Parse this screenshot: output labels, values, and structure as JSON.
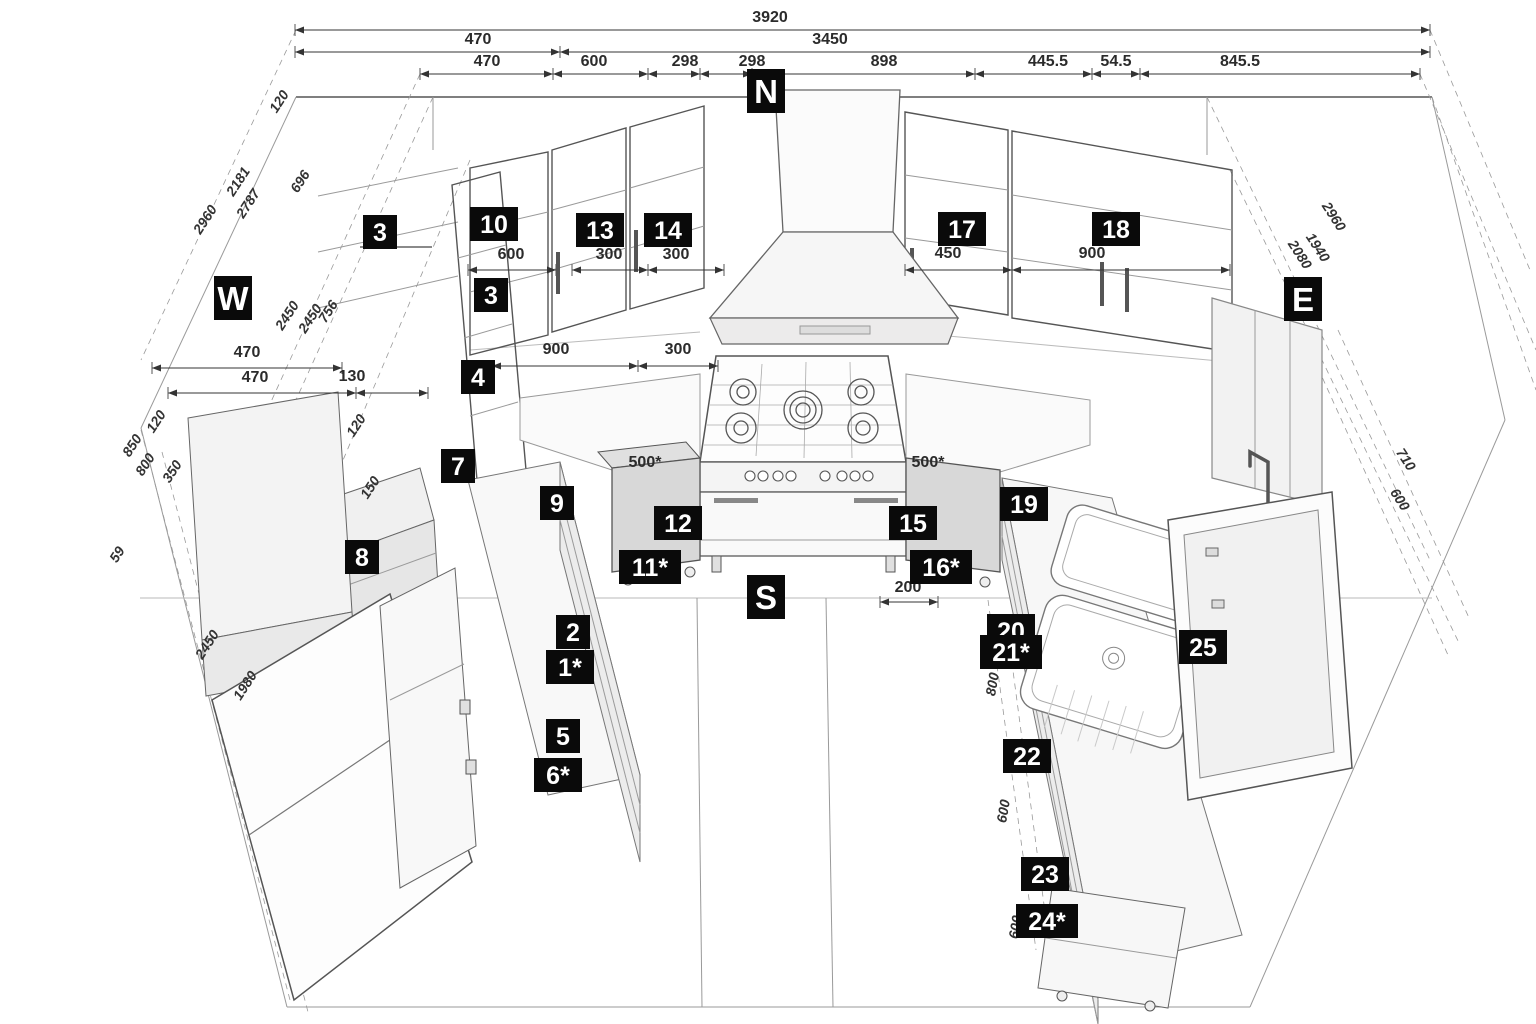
{
  "drawing": {
    "type": "kitchen-3d-dimension-plan",
    "colors": {
      "tag_bg": "#0a0a0a",
      "tag_fg": "#ffffff",
      "dim_line": "#333333",
      "cabinet_fill": "#ebebeb"
    }
  },
  "compass": [
    {
      "label": "N",
      "x": 766,
      "y": 91
    },
    {
      "label": "W",
      "x": 233,
      "y": 298
    },
    {
      "label": "E",
      "x": 1303,
      "y": 299
    },
    {
      "label": "S",
      "x": 766,
      "y": 597
    }
  ],
  "dim_rows": [
    {
      "y": 30,
      "segments": [
        {
          "x1": 295,
          "x2": 1430,
          "label": "3920",
          "tx": 770
        }
      ]
    },
    {
      "y": 52,
      "segments": [
        {
          "x1": 295,
          "x2": 560,
          "label": "470",
          "tx": 478
        },
        {
          "x1": 560,
          "x2": 1430,
          "label": "3450",
          "tx": 830
        }
      ]
    },
    {
      "y": 74,
      "segments": [
        {
          "x1": 420,
          "x2": 553,
          "label": "470",
          "tx": 487
        },
        {
          "x1": 553,
          "x2": 648,
          "label": "600",
          "tx": 594
        },
        {
          "x1": 648,
          "x2": 700,
          "label": "298",
          "tx": 685
        },
        {
          "x1": 700,
          "x2": 752,
          "label": "298",
          "tx": 752
        },
        {
          "x1": 752,
          "x2": 975,
          "label": "898",
          "tx": 884
        },
        {
          "x1": 975,
          "x2": 1092,
          "label": "445.5",
          "tx": 1048
        },
        {
          "x1": 1092,
          "x2": 1140,
          "label": "54.5",
          "tx": 1116
        },
        {
          "x1": 1140,
          "x2": 1420,
          "label": "845.5",
          "tx": 1240
        }
      ]
    }
  ],
  "dims_h": [
    {
      "label": "600",
      "x1": 468,
      "x2": 556,
      "y": 270,
      "tx": 511,
      "ty": 259
    },
    {
      "label": "300",
      "x1": 572,
      "x2": 648,
      "y": 270,
      "tx": 609,
      "ty": 259
    },
    {
      "label": "300",
      "x1": 648,
      "x2": 724,
      "y": 270,
      "tx": 676,
      "ty": 259
    },
    {
      "label": "450",
      "x1": 905,
      "x2": 1012,
      "y": 270,
      "tx": 948,
      "ty": 258
    },
    {
      "label": "900",
      "x1": 1012,
      "x2": 1230,
      "y": 270,
      "tx": 1092,
      "ty": 258
    },
    {
      "label": "900",
      "x1": 492,
      "x2": 638,
      "y": 366,
      "tx": 556,
      "ty": 354
    },
    {
      "label": "300",
      "x1": 638,
      "x2": 718,
      "y": 366,
      "tx": 678,
      "ty": 354
    },
    {
      "label": "200",
      "x1": 880,
      "x2": 938,
      "y": 602,
      "tx": 908,
      "ty": 592
    },
    {
      "label": "470",
      "x1": 152,
      "x2": 342,
      "y": 368,
      "tx": 247,
      "ty": 357
    },
    {
      "label": "470",
      "x1": 168,
      "x2": 356,
      "y": 393,
      "tx": 255,
      "ty": 382
    },
    {
      "label": "130",
      "x1": 356,
      "x2": 428,
      "y": 393,
      "tx": 352,
      "ty": 381
    }
  ],
  "dims_free": [
    {
      "label": "500*",
      "tx": 645,
      "ty": 467
    },
    {
      "label": "500*",
      "tx": 928,
      "ty": 467
    }
  ],
  "dims_rot": [
    {
      "label": "120",
      "x": 283,
      "y": 104,
      "rot": -57
    },
    {
      "label": "2960",
      "x": 209,
      "y": 222,
      "rot": -57
    },
    {
      "label": "2181",
      "x": 242,
      "y": 184,
      "rot": -57
    },
    {
      "label": "2787",
      "x": 252,
      "y": 206,
      "rot": -57
    },
    {
      "label": "696",
      "x": 304,
      "y": 184,
      "rot": -57
    },
    {
      "label": "2450",
      "x": 291,
      "y": 318,
      "rot": -57
    },
    {
      "label": "2450",
      "x": 314,
      "y": 321,
      "rot": -57
    },
    {
      "label": "756",
      "x": 332,
      "y": 314,
      "rot": -57
    },
    {
      "label": "120",
      "x": 360,
      "y": 428,
      "rot": -57
    },
    {
      "label": "120",
      "x": 160,
      "y": 424,
      "rot": -57
    },
    {
      "label": "850",
      "x": 136,
      "y": 448,
      "rot": -57
    },
    {
      "label": "800",
      "x": 149,
      "y": 467,
      "rot": -57
    },
    {
      "label": "350",
      "x": 176,
      "y": 474,
      "rot": -57
    },
    {
      "label": "59",
      "x": 121,
      "y": 557,
      "rot": -57
    },
    {
      "label": "2450",
      "x": 211,
      "y": 647,
      "rot": -57
    },
    {
      "label": "1980",
      "x": 249,
      "y": 688,
      "rot": -57
    },
    {
      "label": "150",
      "x": 374,
      "y": 490,
      "rot": -57
    },
    {
      "label": "2960",
      "x": 1330,
      "y": 219,
      "rot": 57
    },
    {
      "label": "1940",
      "x": 1314,
      "y": 250,
      "rot": 57
    },
    {
      "label": "2080",
      "x": 1296,
      "y": 257,
      "rot": 57
    },
    {
      "label": "710",
      "x": 1402,
      "y": 462,
      "rot": 57
    },
    {
      "label": "600",
      "x": 1396,
      "y": 502,
      "rot": 57
    },
    {
      "label": "800",
      "x": 997,
      "y": 685,
      "rot": -80
    },
    {
      "label": "600",
      "x": 1008,
      "y": 812,
      "rot": -80
    },
    {
      "label": "600",
      "x": 1020,
      "y": 928,
      "rot": -80
    }
  ],
  "tags": [
    {
      "label": "3",
      "x": 380,
      "y": 232
    },
    {
      "label": "10",
      "x": 494,
      "y": 224
    },
    {
      "label": "13",
      "x": 600,
      "y": 230
    },
    {
      "label": "14",
      "x": 668,
      "y": 230
    },
    {
      "label": "17",
      "x": 962,
      "y": 229
    },
    {
      "label": "18",
      "x": 1116,
      "y": 229
    },
    {
      "label": "3",
      "x": 491,
      "y": 295
    },
    {
      "label": "4",
      "x": 478,
      "y": 377
    },
    {
      "label": "7",
      "x": 458,
      "y": 466
    },
    {
      "label": "9",
      "x": 557,
      "y": 503
    },
    {
      "label": "8",
      "x": 362,
      "y": 557
    },
    {
      "label": "12",
      "x": 678,
      "y": 523
    },
    {
      "label": "11*",
      "x": 650,
      "y": 567
    },
    {
      "label": "15",
      "x": 913,
      "y": 523
    },
    {
      "label": "16*",
      "x": 941,
      "y": 567
    },
    {
      "label": "19",
      "x": 1024,
      "y": 504
    },
    {
      "label": "2",
      "x": 573,
      "y": 632
    },
    {
      "label": "1*",
      "x": 570,
      "y": 667
    },
    {
      "label": "5",
      "x": 563,
      "y": 736
    },
    {
      "label": "6*",
      "x": 558,
      "y": 775
    },
    {
      "label": "20",
      "x": 1011,
      "y": 631
    },
    {
      "label": "21*",
      "x": 1011,
      "y": 652
    },
    {
      "label": "22",
      "x": 1027,
      "y": 756
    },
    {
      "label": "25",
      "x": 1203,
      "y": 647
    },
    {
      "label": "23",
      "x": 1045,
      "y": 874
    },
    {
      "label": "24*",
      "x": 1047,
      "y": 921
    }
  ]
}
